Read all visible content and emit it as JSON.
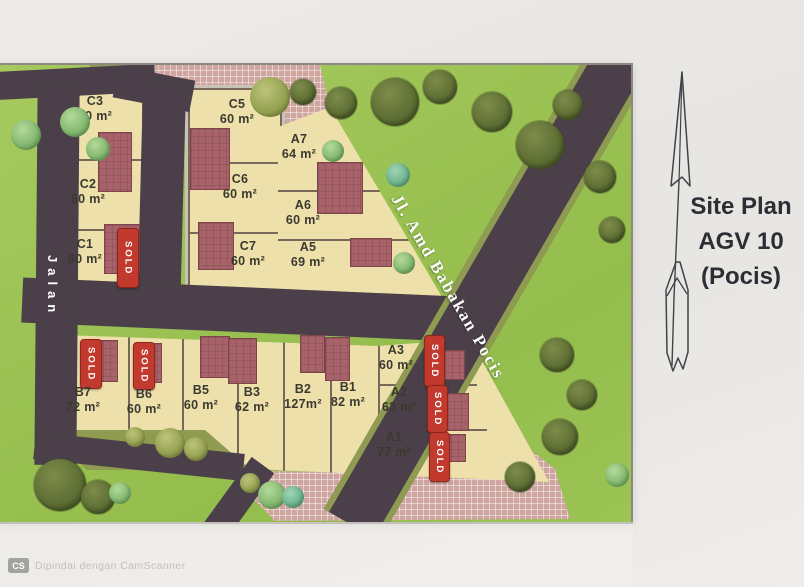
{
  "title_panel": {
    "line1": "Site Plan",
    "line2": "AGV 10",
    "line3": "(Pocis)"
  },
  "roads": {
    "main": "Jl. Amd Babakan Pocis",
    "side": "Jalan"
  },
  "labels": {
    "sold": "SOLD"
  },
  "lots": {
    "C3": {
      "name": "C3",
      "area": "60 m²",
      "status": "available"
    },
    "C2": {
      "name": "C2",
      "area": "60 m²",
      "status": "available"
    },
    "C1": {
      "name": "C1",
      "area": "60 m²",
      "status": "sold"
    },
    "C5": {
      "name": "C5",
      "area": "60 m²",
      "status": "available"
    },
    "C6": {
      "name": "C6",
      "area": "60 m²",
      "status": "available"
    },
    "C7": {
      "name": "C7",
      "area": "60 m²",
      "status": "available"
    },
    "A7": {
      "name": "A7",
      "area": "64 m²",
      "status": "available"
    },
    "A6": {
      "name": "A6",
      "area": "60 m²",
      "status": "available"
    },
    "A5": {
      "name": "A5",
      "area": "69 m²",
      "status": "available"
    },
    "B7": {
      "name": "B7",
      "area": "72 m²",
      "status": "sold"
    },
    "B6": {
      "name": "B6",
      "area": "60 m²",
      "status": "sold"
    },
    "B5": {
      "name": "B5",
      "area": "60 m²",
      "status": "available"
    },
    "B3": {
      "name": "B3",
      "area": "62 m²",
      "status": "available"
    },
    "B2": {
      "name": "B2",
      "area": "127m²",
      "status": "available"
    },
    "B1": {
      "name": "B1",
      "area": "82 m²",
      "status": "available"
    },
    "A3": {
      "name": "A3",
      "area": "60 m²",
      "status": "sold"
    },
    "A2": {
      "name": "A2",
      "area": "63 m²",
      "status": "sold"
    },
    "A1": {
      "name": "A1",
      "area": "77 m²",
      "status": "sold"
    }
  },
  "watermark": {
    "badge": "CS",
    "text": "Dipindai dengan CamScanner"
  },
  "colors": {
    "road": "#4b4049",
    "grass": "#9cc455",
    "lot": "#eee0aa",
    "building": "#a8636a",
    "sold": "#c13a2d",
    "hatch": "#cfa5a0",
    "ink": "#2e2d35",
    "verge": "#8e9b51"
  }
}
